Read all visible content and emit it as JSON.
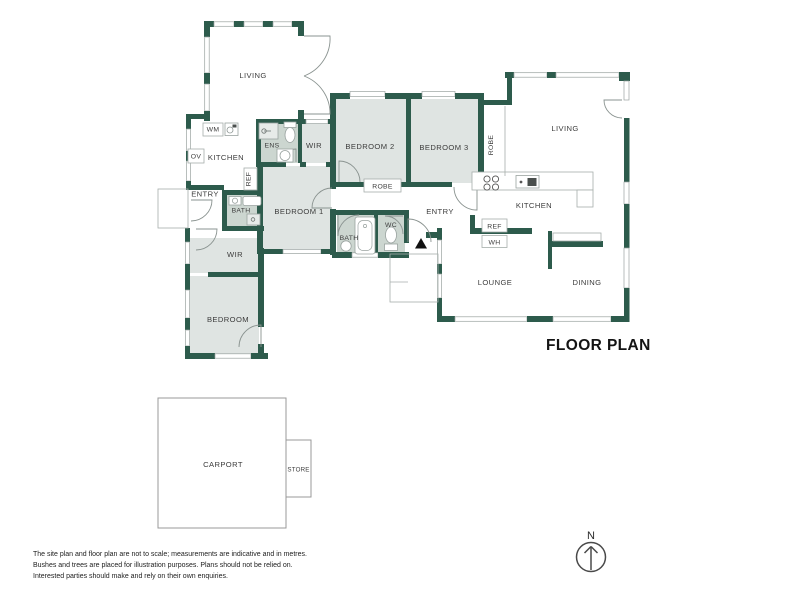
{
  "title": "FLOOR PLAN",
  "compass": {
    "north": "N"
  },
  "palette": {
    "wall_green": "#2d5b4c",
    "room_gray": "#dfe4e2",
    "room_shaded": "#ccd6d0",
    "fixture_light": "#e7ebe9",
    "outline_gray": "#9aa3a0",
    "text": "#3c3c3c"
  },
  "labels": {
    "living_top": "LIVING",
    "living_right": "LIVING",
    "kitchen_left": "KITCHEN",
    "kitchen_right": "KITCHEN",
    "wm": "WM",
    "ov": "OV",
    "ens": "ENS",
    "wir_top": "WIR",
    "wir_lower": "WIR",
    "bedroom1": "BEDROOM 1",
    "bedroom2": "BEDROOM 2",
    "bedroom3": "BEDROOM 3",
    "bedroom_rear": "BEDROOM",
    "robe_vertical": "ROBE",
    "robe_hall": "ROBE",
    "ref_left": "REF",
    "ref_right": "REF",
    "wh": "WH",
    "bath_left": "BATH",
    "bath_main": "BATH",
    "wc": "WC",
    "entry_left": "ENTRY",
    "entry_right": "ENTRY",
    "lounge": "LOUNGE",
    "dining": "DINING",
    "carport": "CARPORT",
    "store": "STORE"
  },
  "disclaimer": {
    "line1": "The site plan and floor plan are not to scale; measurements are indicative and in metres.",
    "line2": "Bushes and trees are placed for illustration purposes. Plans should not be relied on.",
    "line3": "Interested parties should make and rely on their own enquiries."
  }
}
